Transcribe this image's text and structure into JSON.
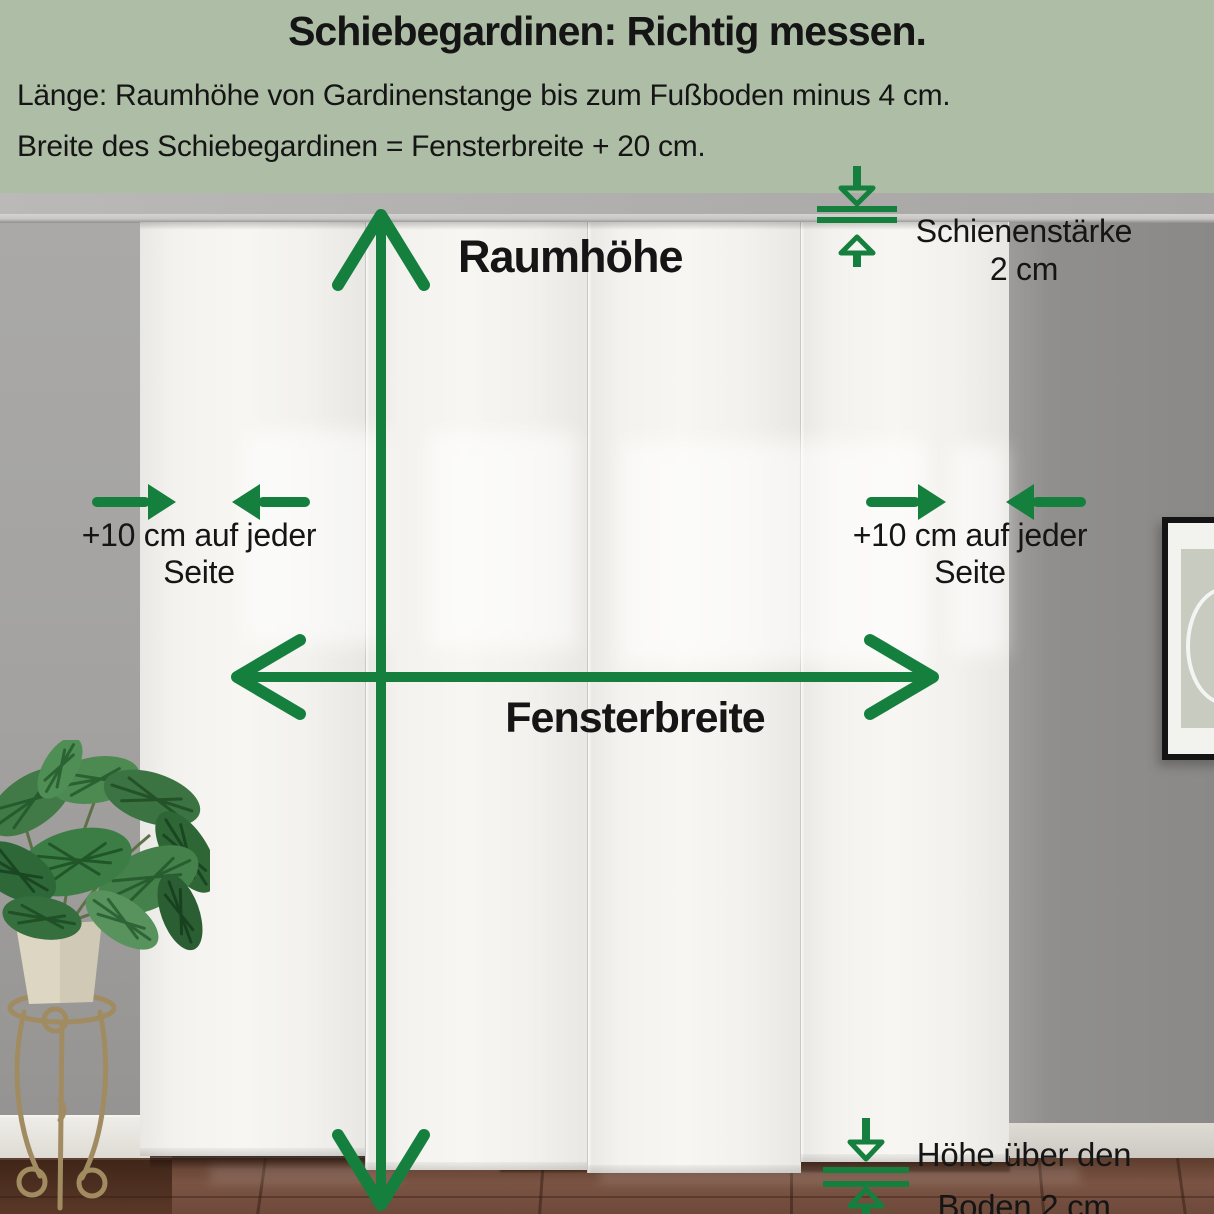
{
  "header": {
    "title": "Schiebegardinen: Richtig messen.",
    "instruction_line1": "Länge: Raumhöhe von Gardinenstange bis zum Fußboden minus 4 cm.",
    "instruction_line2": "Breite des Schiebegardinen = Fensterbreite + 20 cm."
  },
  "annotations": {
    "room_height": "Raumhöhe",
    "window_width": "Fensterbreite",
    "rail_thickness": {
      "line1": "Schienenstärke",
      "line2": "2 cm"
    },
    "side_offset_left": {
      "line1": "+10 cm auf jeder",
      "line2": "Seite"
    },
    "side_offset_right": {
      "line1": "+10 cm auf jeder",
      "line2": "Seite"
    },
    "floor_clearance": {
      "line1": "Höhe über den",
      "line2": "Boden 2 cm"
    }
  },
  "colors": {
    "header_background": "#aebda5",
    "arrow_green": "#157f3e",
    "text": "#161616",
    "curtain_white": "#f3f2ee",
    "wall_gray": "#9a9998",
    "floor_brown": "#6e4a3b"
  },
  "icons": {
    "room_height_arrow": "double-headed-vertical-arrow",
    "window_width_arrow": "double-headed-horizontal-arrow",
    "side_offset_arrows": "converging-horizontal-arrows",
    "rail_thickness_indicator": "converging-vertical-arrows-with-rail-lines",
    "floor_clearance_indicator": "converging-vertical-arrows-with-gap-lines"
  }
}
